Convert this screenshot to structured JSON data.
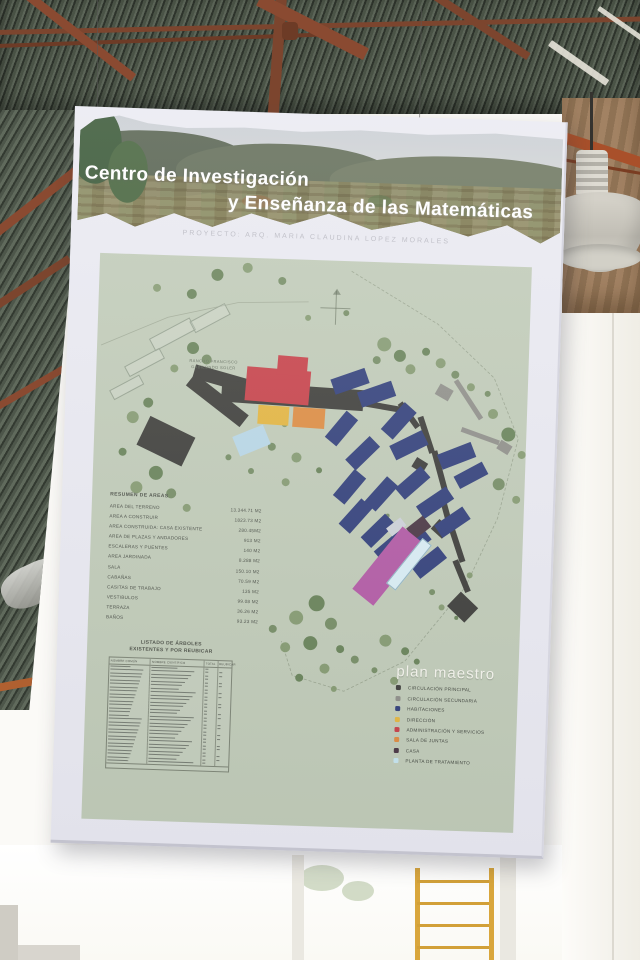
{
  "poster": {
    "title_line1": "Centro de Investigación",
    "title_line2": "y Enseñanza de las Matemáticas",
    "subtitle": "PROYECTO: ARQ. MARIA CLAUDINA LOPEZ MORALES"
  },
  "map": {
    "background": "#bfcab6",
    "site_label_line1": "RANCHO FRANCISCO",
    "site_label_line2": "GABILONDO SOLER",
    "boundary_path": "M252,10 L340,60 L398,112 L424,172 L406,252 L376,322 L318,398 L258,430 L206,416 L194,382",
    "road_path": "M4,92 L70,62 L140,45 L210,42",
    "areas_table": {
      "title": "RESUMEN DE AREAS",
      "rows": [
        {
          "label": "AREA DEL TERRENO",
          "value": "13.344.71 M2"
        },
        {
          "label": "AREA A CONSTRUIR",
          "value": "1823.73 M2"
        },
        {
          "label": "AREA CONSTRUIDA: CASA EXISTENTE",
          "value": "280.45M2"
        },
        {
          "label": "AREA DE PLAZAS Y ANDADORES",
          "value": "913 M2"
        },
        {
          "label": "ESCALERAS Y PUENTES",
          "value": "140 M2"
        },
        {
          "label": "AREA JARDINADA",
          "value": "8.288 M2"
        },
        {
          "label": "SALA",
          "value": "150.10 M2"
        },
        {
          "label": "CABAÑAS",
          "value": "70.59 M2"
        },
        {
          "label": "CASITAS DE TRABAJO",
          "value": "135 M2"
        },
        {
          "label": "VESTIBULOS",
          "value": "99.08 M2"
        },
        {
          "label": "TERRAZA",
          "value": "36.26 M2"
        },
        {
          "label": "BAÑOS",
          "value": "93.23 M2"
        }
      ]
    },
    "trees_table": {
      "title_line1": "LISTADO DE ÁRBOLES",
      "title_line2": "EXISTENTES Y POR REUBICAR",
      "col_headers": [
        "NOMBRE COMÚN",
        "NOMBRE CIENTÍFICO",
        "TOTAL",
        "REUBICAR"
      ],
      "row_count": 28
    },
    "legend": {
      "title": "plan maestro",
      "items": [
        {
          "color": "#3b3b38",
          "label": "CIRCULACIÓN PRINCIPAL"
        },
        {
          "color": "#8d8d87",
          "label": "CIRCULACIÓN SECUNDARIA"
        },
        {
          "color": "#2e3c78",
          "label": "HABITACIONES"
        },
        {
          "color": "#e3b43c",
          "label": "DIRECCIÓN"
        },
        {
          "color": "#c63d45",
          "label": "ADMINISTRACIÓN Y SERVICIOS"
        },
        {
          "color": "#dd8a3e",
          "label": "SALA DE JUNTAS"
        },
        {
          "color": "#473341",
          "label": "CASA"
        },
        {
          "color": "#c5e4ee",
          "label": "PLANTA DE TRATAMIENTO"
        }
      ]
    },
    "palette": {
      "main": "#3a3a36",
      "sec": "#8d8d87",
      "hab": "#2e3c78",
      "adm": "#c63d45",
      "dir": "#e3b43c",
      "jun": "#dd8a3e",
      "casa": "#473341",
      "trat": "#b7d6e6",
      "trat2": "#d8edf4",
      "sala": "#b157a3",
      "pale": "#cdd1d8",
      "outline": "outline"
    },
    "buildings": [
      [
        97,
        116,
        66,
        14,
        14,
        "main"
      ],
      [
        126,
        126,
        142,
        21,
        2,
        "main"
      ],
      [
        88,
        136,
        68,
        15,
        36,
        "main"
      ],
      [
        47,
        170,
        50,
        32,
        24,
        "main"
      ],
      [
        263,
        141,
        46,
        6,
        8,
        "main"
      ],
      [
        299,
        149,
        30,
        6,
        52,
        "main"
      ],
      [
        313,
        168,
        38,
        6,
        70,
        "main"
      ],
      [
        320,
        196,
        13,
        11,
        30,
        "main"
      ],
      [
        325,
        205,
        44,
        6,
        73,
        "main"
      ],
      [
        334,
        243,
        40,
        6,
        73,
        "main"
      ],
      [
        342,
        258,
        15,
        13,
        40,
        "main"
      ],
      [
        347,
        276,
        38,
        6,
        70,
        "main"
      ],
      [
        355,
        308,
        34,
        6,
        66,
        "main"
      ],
      [
        362,
        332,
        24,
        20,
        42,
        "main"
      ],
      [
        341,
        122,
        15,
        12,
        28,
        "sec"
      ],
      [
        350,
        132,
        46,
        5,
        55,
        "sec"
      ],
      [
        366,
        168,
        40,
        5,
        18,
        "sec"
      ],
      [
        404,
        176,
        13,
        10,
        30,
        "sec"
      ],
      [
        236,
        112,
        36,
        16,
        -21,
        "hab"
      ],
      [
        263,
        124,
        36,
        16,
        -21,
        "hab"
      ],
      [
        286,
        150,
        36,
        16,
        -50,
        "hab"
      ],
      [
        230,
        160,
        34,
        15,
        -52,
        "hab"
      ],
      [
        297,
        174,
        36,
        16,
        -28,
        "hab"
      ],
      [
        252,
        184,
        34,
        15,
        -46,
        "hab"
      ],
      [
        345,
        183,
        36,
        16,
        -23,
        "hab"
      ],
      [
        362,
        203,
        32,
        14,
        -30,
        "hab"
      ],
      [
        240,
        218,
        34,
        15,
        -52,
        "hab"
      ],
      [
        272,
        224,
        34,
        15,
        -50,
        "hab"
      ],
      [
        303,
        212,
        34,
        15,
        -43,
        "hab"
      ],
      [
        325,
        231,
        36,
        15,
        -36,
        "hab"
      ],
      [
        344,
        250,
        34,
        15,
        -36,
        "hab"
      ],
      [
        247,
        247,
        34,
        15,
        -50,
        "hab"
      ],
      [
        270,
        261,
        34,
        15,
        -46,
        "hab"
      ],
      [
        284,
        276,
        34,
        15,
        -42,
        "hab"
      ],
      [
        306,
        273,
        34,
        15,
        -40,
        "hab"
      ],
      [
        322,
        291,
        34,
        15,
        -40,
        "hab"
      ],
      [
        150,
        110,
        64,
        34,
        3,
        "adm"
      ],
      [
        181,
        97,
        30,
        19,
        3,
        "adm"
      ],
      [
        163,
        147,
        31,
        19,
        2,
        "dir"
      ],
      [
        198,
        148,
        32,
        20,
        2,
        "jun"
      ],
      [
        141,
        172,
        33,
        21,
        -24,
        "trat"
      ],
      [
        317,
        257,
        21,
        14,
        -40,
        "casa"
      ],
      [
        296,
        259,
        18,
        10,
        -40,
        "pale"
      ],
      [
        258,
        290,
        80,
        27,
        -53,
        "sala"
      ],
      [
        290,
        295,
        58,
        12,
        -53,
        "trat2"
      ],
      [
        52,
        72,
        46,
        14,
        -30,
        "outline"
      ],
      [
        92,
        55,
        40,
        13,
        -30,
        "outline"
      ],
      [
        28,
        102,
        40,
        12,
        -30,
        "outline"
      ],
      [
        14,
        128,
        34,
        11,
        -30,
        "outline"
      ]
    ],
    "tree_tones": [
      "#7e9569",
      "#5e7b4e",
      "#6d855b"
    ],
    "trees": [
      [
        118,
        18,
        6,
        1
      ],
      [
        148,
        10,
        5,
        0
      ],
      [
        183,
        22,
        4,
        2
      ],
      [
        210,
        58,
        3,
        0
      ],
      [
        248,
        52,
        3,
        2
      ],
      [
        93,
        38,
        5,
        1
      ],
      [
        58,
        33,
        4,
        0
      ],
      [
        287,
        82,
        7,
        0
      ],
      [
        303,
        93,
        6,
        1
      ],
      [
        314,
        106,
        5,
        0
      ],
      [
        280,
        98,
        4,
        2
      ],
      [
        329,
        88,
        4,
        1
      ],
      [
        344,
        99,
        5,
        0
      ],
      [
        359,
        110,
        4,
        2
      ],
      [
        375,
        122,
        4,
        0
      ],
      [
        96,
        92,
        6,
        1
      ],
      [
        110,
        103,
        5,
        2
      ],
      [
        78,
        113,
        4,
        0
      ],
      [
        53,
        148,
        5,
        1
      ],
      [
        38,
        163,
        6,
        0
      ],
      [
        63,
        218,
        7,
        1
      ],
      [
        44,
        233,
        6,
        0
      ],
      [
        79,
        238,
        5,
        2
      ],
      [
        29,
        198,
        4,
        1
      ],
      [
        95,
        252,
        4,
        0
      ],
      [
        178,
        188,
        4,
        2
      ],
      [
        203,
        198,
        5,
        0
      ],
      [
        226,
        210,
        3,
        1
      ],
      [
        193,
        223,
        4,
        0
      ],
      [
        158,
        213,
        3,
        2
      ],
      [
        398,
        148,
        5,
        0
      ],
      [
        414,
        168,
        7,
        1
      ],
      [
        428,
        188,
        4,
        0
      ],
      [
        406,
        218,
        6,
        2
      ],
      [
        424,
        233,
        4,
        0
      ],
      [
        392,
        128,
        3,
        2
      ],
      [
        228,
        343,
        8,
        1
      ],
      [
        208,
        358,
        7,
        0
      ],
      [
        243,
        363,
        6,
        2
      ],
      [
        223,
        383,
        7,
        1
      ],
      [
        198,
        388,
        5,
        0
      ],
      [
        253,
        388,
        4,
        1
      ],
      [
        238,
        408,
        5,
        0
      ],
      [
        268,
        398,
        4,
        2
      ],
      [
        213,
        418,
        4,
        1
      ],
      [
        248,
        428,
        3,
        0
      ],
      [
        185,
        370,
        4,
        2
      ],
      [
        298,
        378,
        6,
        0
      ],
      [
        318,
        388,
        4,
        1
      ],
      [
        288,
        408,
        3,
        2
      ],
      [
        308,
        418,
        4,
        0
      ],
      [
        330,
        398,
        3,
        1
      ],
      [
        353,
        343,
        3,
        0
      ],
      [
        368,
        353,
        2,
        1
      ],
      [
        343,
        328,
        3,
        2
      ],
      [
        380,
        310,
        3,
        0
      ],
      [
        263,
        213,
        3,
        1
      ],
      [
        283,
        238,
        3,
        0
      ],
      [
        296,
        253,
        2,
        2
      ],
      [
        190,
        165,
        3,
        0
      ],
      [
        135,
        200,
        3,
        2
      ]
    ]
  }
}
